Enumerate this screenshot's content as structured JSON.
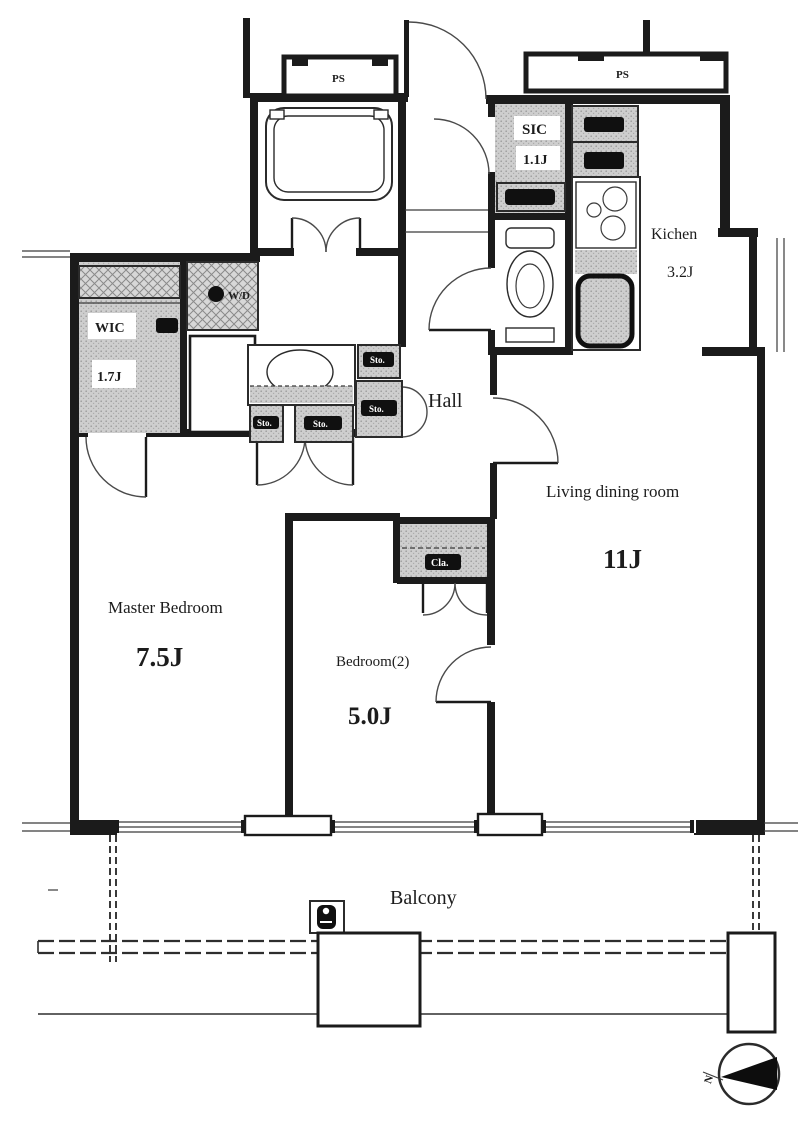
{
  "plan": {
    "rooms": {
      "master_bedroom": {
        "name": "Master Bedroom",
        "area": "7.5J"
      },
      "bedroom2": {
        "name": "Bedroom(2)",
        "area": "5.0J"
      },
      "living_dining": {
        "name": "Living dining room",
        "area": "11J"
      },
      "kitchen": {
        "name": "Kichen",
        "area": "3.2J"
      },
      "hall": {
        "name": "Hall"
      },
      "wic": {
        "name": "WIC",
        "area": "1.7J"
      },
      "sic": {
        "name": "SIC",
        "area": "1.1J"
      },
      "balcony": {
        "name": "Balcony"
      }
    },
    "closets": {
      "cla": "Cla.",
      "storage": [
        "Sto.",
        "Sto.",
        "Sto.",
        "Sto."
      ],
      "wd": "W/D"
    },
    "shafts": {
      "ps_left": "PS",
      "ps_right": "PS"
    },
    "compass": {
      "north": "N"
    },
    "colors": {
      "wall": "#1b1b1b",
      "shade": "#cccccc",
      "paper": "#ffffff"
    }
  }
}
